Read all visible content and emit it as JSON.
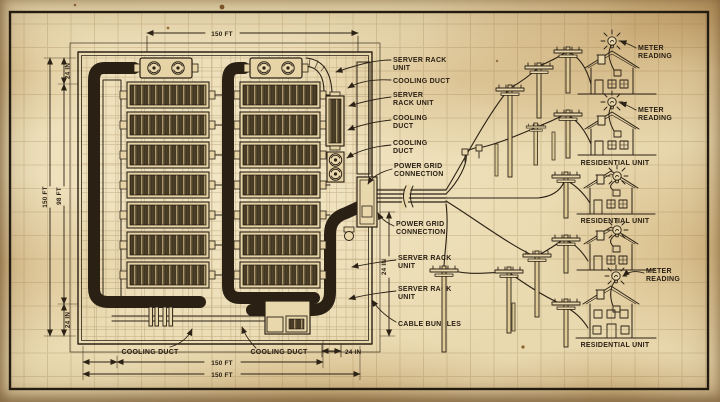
{
  "palette": {
    "paper": "#e9d9af",
    "paper_stain": "#c9a873",
    "ink": "#2b2115",
    "frame": "#241c10",
    "grid": "#8a6a3a"
  },
  "dimensions": {
    "top_width": "150 FT",
    "left_outer_height": "150 FT",
    "left_inner_height": "98 FT",
    "left_top_offset": "24 IN",
    "left_bottom_offset": "24 IN",
    "right_side_offset": "24 IN",
    "bottom_inner_width": "150 FT",
    "bottom_outer_width": "150 FT",
    "bottom_right_offset": "24 IN"
  },
  "callouts": {
    "server_rack_unit_a": [
      "SERVER RACK",
      "UNIT"
    ],
    "cooling_duct_a": [
      "COOLING DUCT"
    ],
    "server_rack_unit_b": [
      "SERVER",
      "RACK UNIT"
    ],
    "cooling_duct_b": [
      "COOLING",
      "DUCT"
    ],
    "cooling_duct_c": [
      "COOLING",
      "DUCT"
    ],
    "power_grid_a": [
      "POWER GRID",
      "CONNECTION"
    ],
    "power_grid_b": [
      "POWER GRID",
      "CONNECTION"
    ],
    "server_rack_unit_c": [
      "SERVER RACK",
      "UNIT"
    ],
    "server_rack_unit_d": [
      "SERVER RACK",
      "UNIT"
    ],
    "cable_bundles": [
      "CABLE BUNDLES"
    ],
    "cooling_duct_bottom_left": [
      "COOLING DUCT"
    ],
    "cooling_duct_bottom_right": [
      "COOLING DUCT"
    ]
  },
  "network": {
    "meter_reading": [
      "METER",
      "READING"
    ],
    "residential_unit": "RESIDENTIAL UNIT"
  }
}
